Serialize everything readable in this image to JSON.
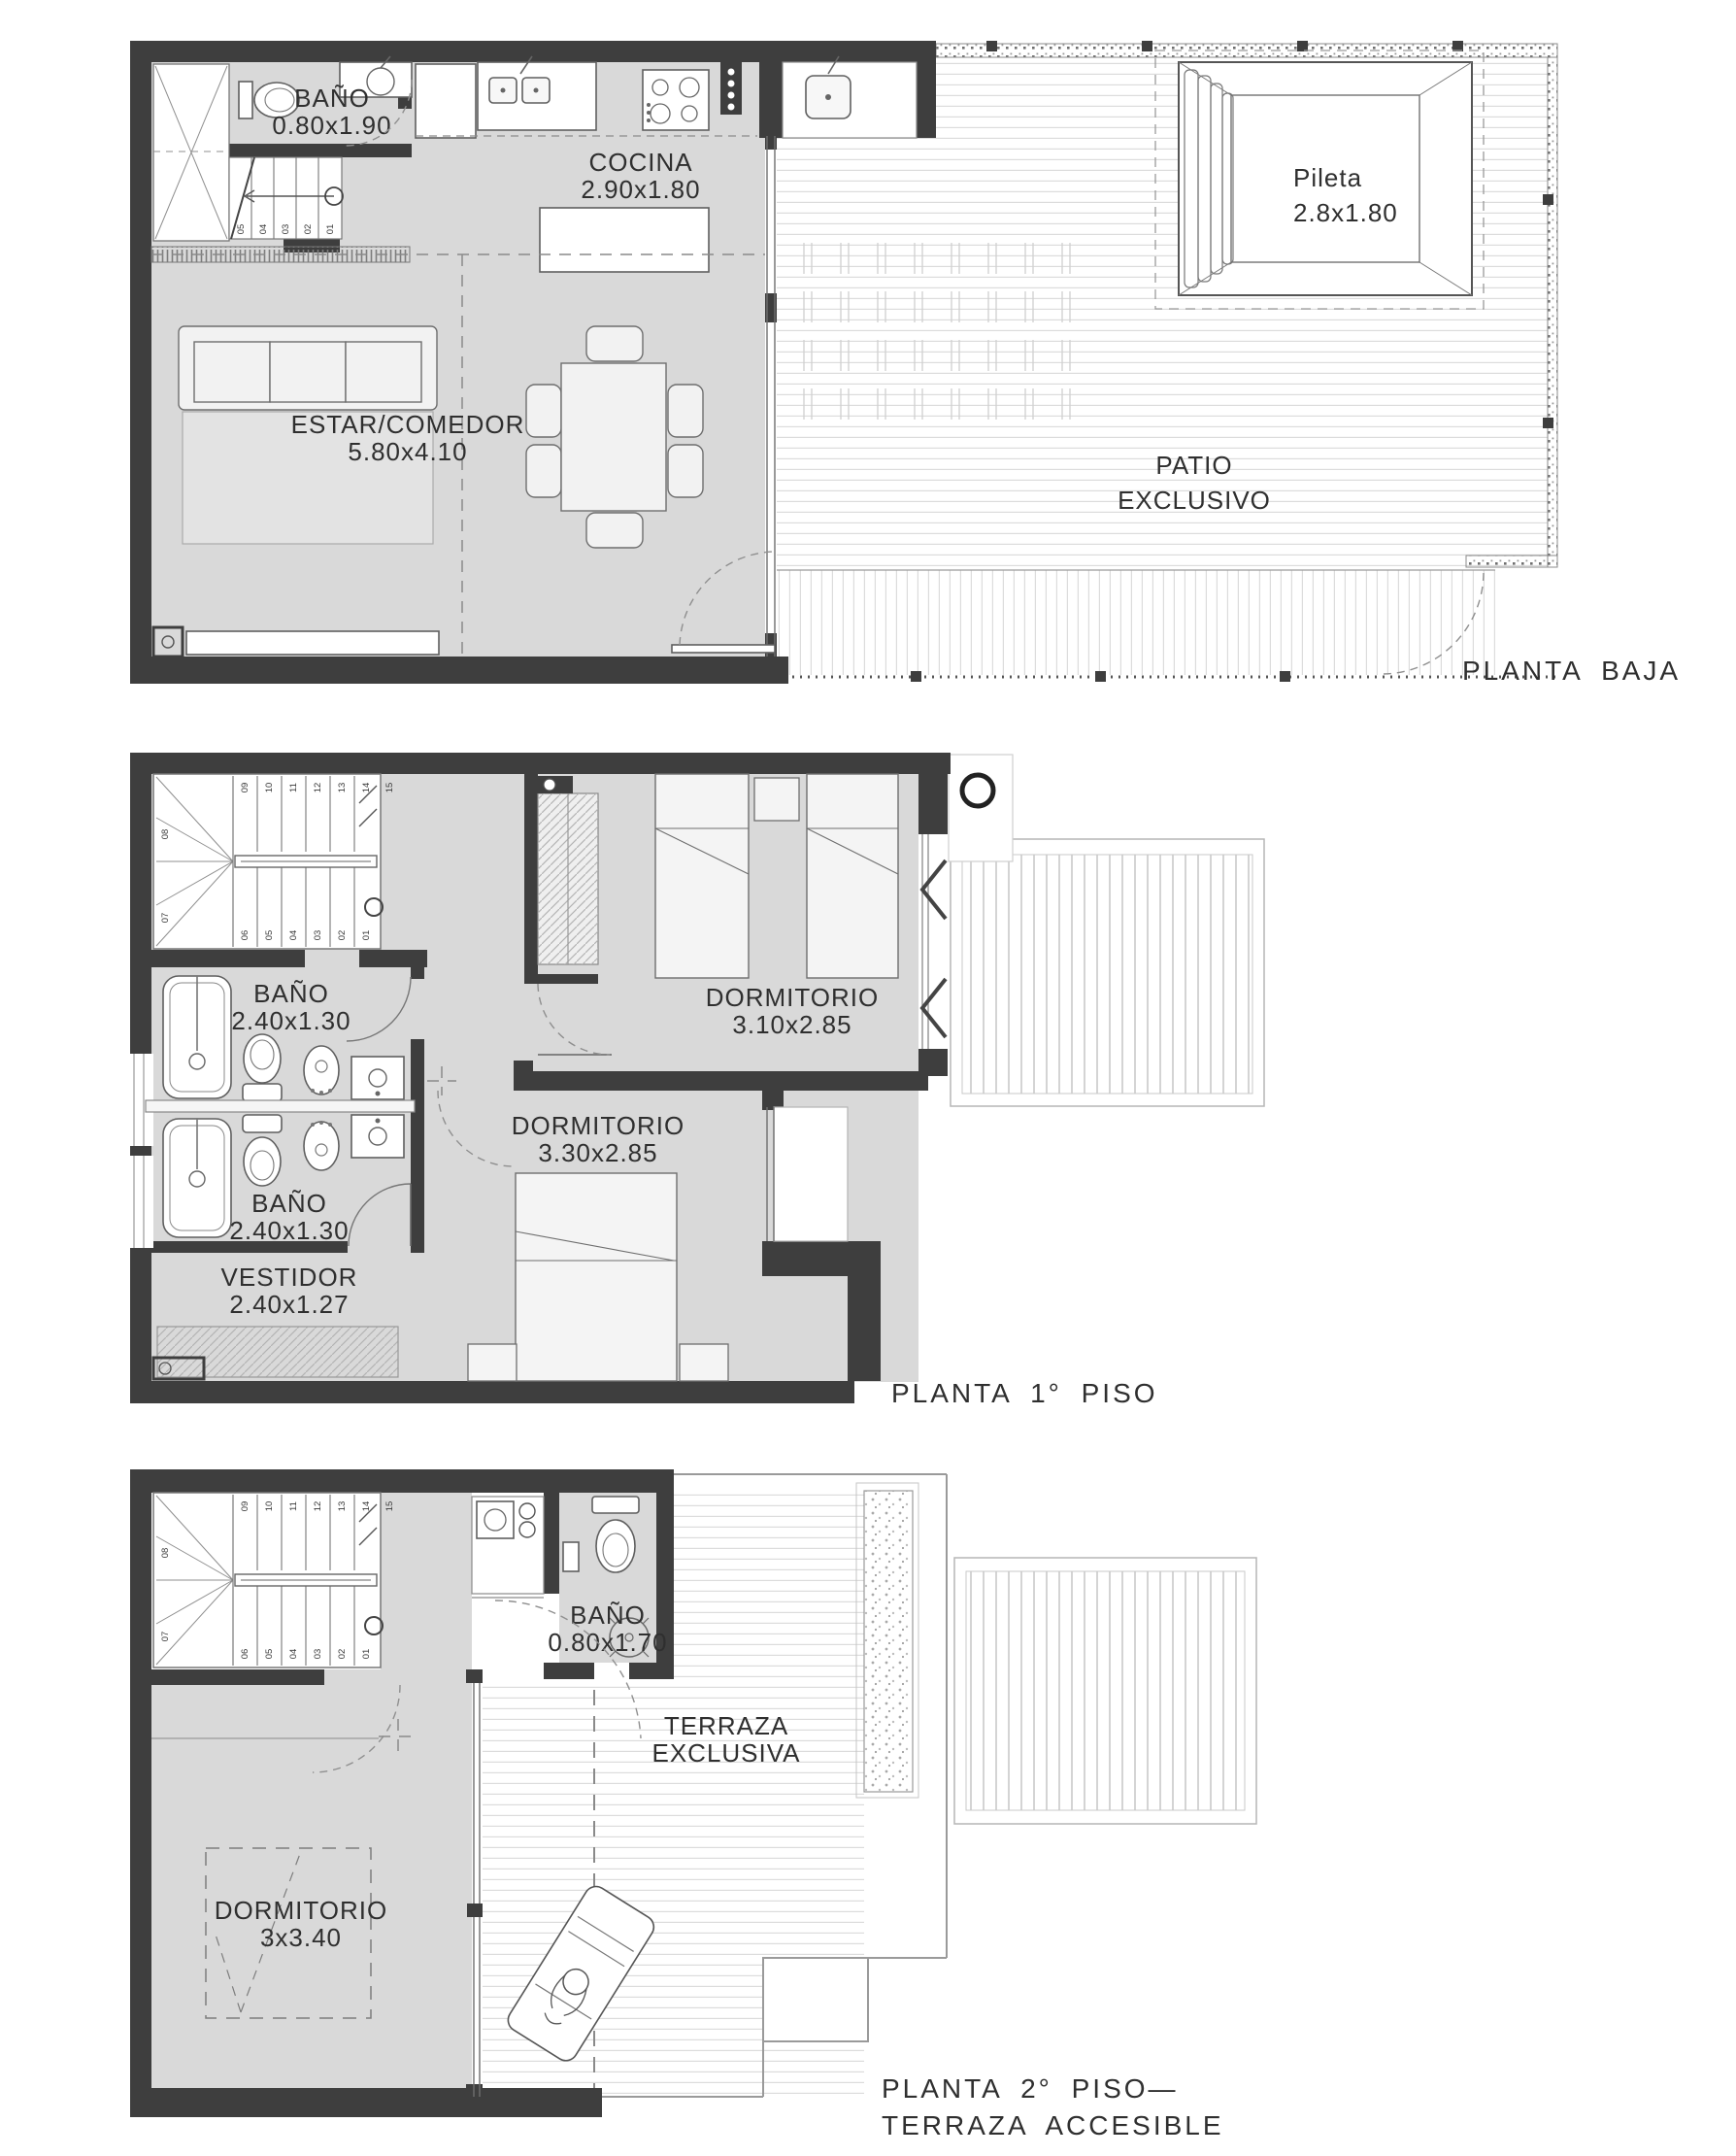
{
  "document": {
    "type": "architectural-floor-plan",
    "units_note": "room dimensions in meters as printed"
  },
  "colors": {
    "wall": "#3e3e3e",
    "floor": "#d9d9d9",
    "white": "#ffffff",
    "deck_line": "#dcdcdc",
    "text": "#2f2f2f"
  },
  "floor1": {
    "title": "PLANTA BAJA",
    "bano": {
      "name": "BAÑO",
      "dims": "0.80x1.90"
    },
    "cocina": {
      "name": "COCINA",
      "dims": "2.90x1.80"
    },
    "estar": {
      "name": "ESTAR/COMEDOR",
      "dims": "5.80x4.10"
    },
    "pileta": {
      "name": "Pileta",
      "dims": "2.8x1.80"
    },
    "patio": {
      "line1": "PATIO",
      "line2": "EXCLUSIVO"
    },
    "stairs": [
      "05",
      "04",
      "03",
      "02",
      "01"
    ]
  },
  "floor2": {
    "title": "PLANTA 1° PISO",
    "bano_sup": {
      "name": "BAÑO",
      "dims": "2.40x1.30"
    },
    "bano_inf": {
      "name": "BAÑO",
      "dims": "2.40x1.30"
    },
    "vestidor": {
      "name": "VESTIDOR",
      "dims": "2.40x1.27"
    },
    "dorm1": {
      "name": "DORMITORIO",
      "dims": "3.10x2.85"
    },
    "dorm2": {
      "name": "DORMITORIO",
      "dims": "3.30x2.85"
    }
  },
  "floor3": {
    "title1": "PLANTA 2° PISO—",
    "title2": "TERRAZA ACCESIBLE",
    "bano": {
      "name": "BAÑO",
      "dims": "0.80x1.70"
    },
    "terraza": {
      "line1": "TERRAZA",
      "line2": "EXCLUSIVA"
    },
    "dorm": {
      "name": "DORMITORIO",
      "dims": "3x3.40"
    }
  },
  "stairs15": {
    "upper": [
      "09",
      "10",
      "11",
      "12",
      "13",
      "14"
    ],
    "top": "15",
    "side": [
      "08",
      "07"
    ],
    "lower": [
      "06",
      "05",
      "04",
      "03",
      "02",
      "01"
    ]
  }
}
